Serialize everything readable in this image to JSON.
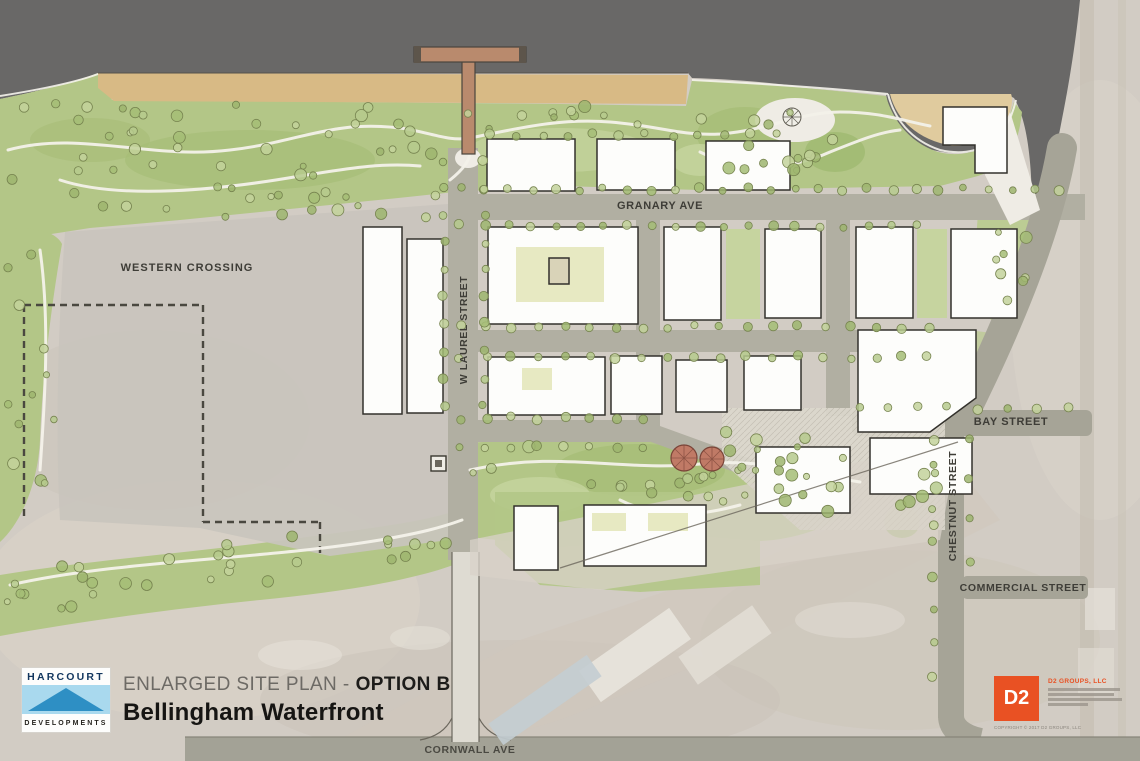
{
  "map": {
    "street_labels": {
      "granary_ave": "GRANARY AVE",
      "w_laurel_street": "W LAUREL STREET",
      "bay_street": "BAY STREET",
      "chestnut_street": "CHESTNUT STREET",
      "commercial_street": "COMMERCIAL STREET",
      "cornwall_ave": "CORNWALL AVE"
    },
    "area_labels": {
      "western_crossing": "WESTERN CROSSING"
    }
  },
  "title_block": {
    "logo_top": "HARCOURT",
    "logo_bottom": "DEVELOPMENTS",
    "plan_type": "ENLARGED SITE PLAN -",
    "option": "OPTION B",
    "project": "Bellingham Waterfront"
  },
  "firm_block": {
    "logo_text": "D2",
    "company": "D2 GROUPS, LLC",
    "copyright": "COPYRIGHT © 2017 D2 GROUPS, LLC"
  },
  "colors": {
    "water": "#696867",
    "beach_sand": "#d8ba85",
    "park_green": "#b3c687",
    "street_gray": "#b1afa2",
    "aerial_gray": "#d2ccc4",
    "building_white": "#fdfdfb",
    "d2_orange": "#e95123",
    "harcourt_blue": "#2e8fc4"
  }
}
